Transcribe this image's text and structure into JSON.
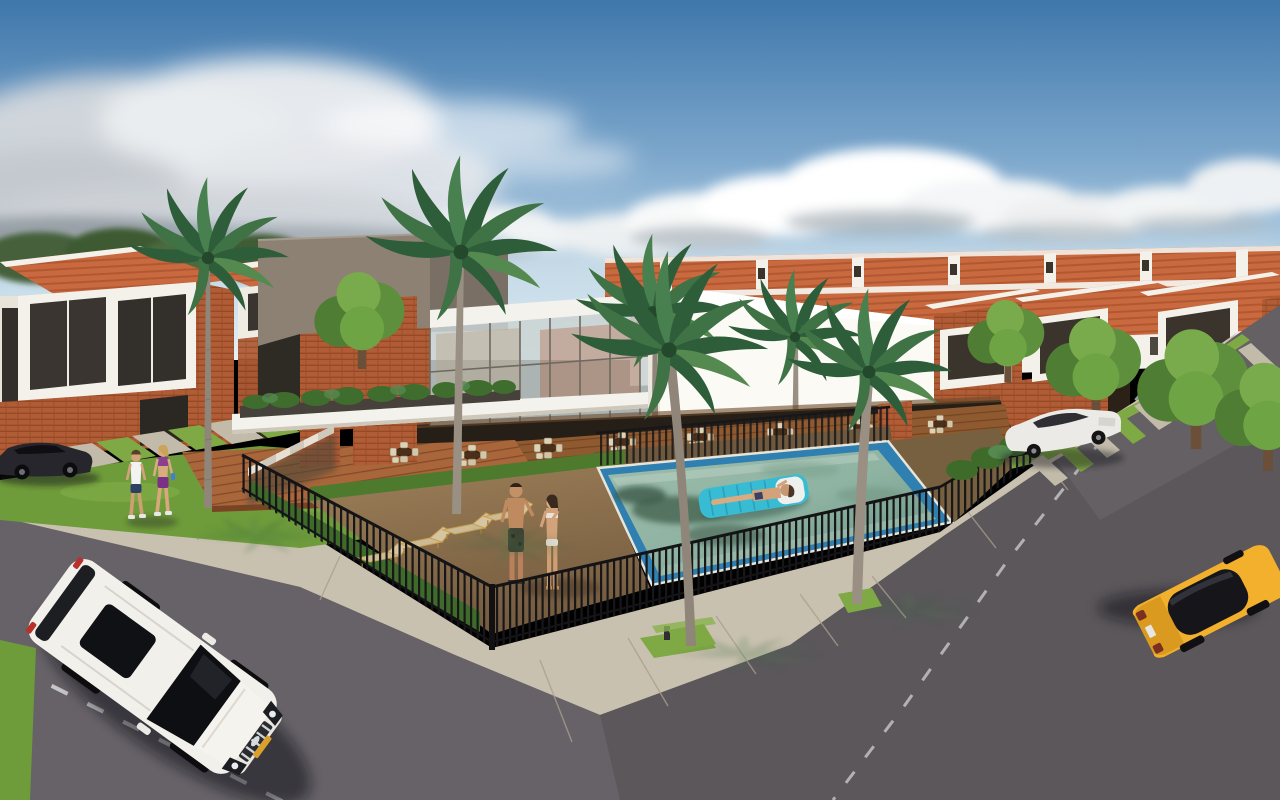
{
  "scene": {
    "type": "3d-architectural-rendering",
    "subject": "Gated townhouse community with central clubhouse, terrace restaurant, swimming pool and corner streets",
    "setting": "daytime, partly cloudy sky, tropical palms",
    "elements": [
      "sky-with-clouds",
      "townhouse-rows-with-tile-roofs",
      "clubhouse-with-glass-facade",
      "terrace-restaurant",
      "swimming-pool",
      "sunbather-on-float",
      "sand-lounge-area-with-loungers",
      "poolside-couple",
      "wrought-iron-fence",
      "palm-trees",
      "front-street",
      "side-street",
      "concrete-sidewalks",
      "white-suv",
      "yellow-sports-car",
      "white-sedan",
      "dark-parked-car",
      "two-women-walking"
    ]
  },
  "colors": {
    "sky_top": "#3f77ab",
    "sky_mid": "#7fa9cd",
    "sky_low": "#c6dcea",
    "sky_horizon": "#e9f0f2",
    "cloud_white": "#ffffff",
    "cloud_gray": "#aeb6bd",
    "roof_orange": "#c8693f",
    "roof_line": "#a34c28",
    "wall_white": "#f4f1ea",
    "gable_white": "#fbfaf5",
    "brick": "#b05c36",
    "glass_dark": "#37322b",
    "taupe_front": "#8d8174",
    "taupe_side": "#7a6f64",
    "slab_white": "#f4f2ec",
    "hedge": "#3e6b2a",
    "lawn": "#6f9c3a",
    "grass_strip": "#7fa944",
    "sand": "#83684a",
    "pool_border": "#2f7fb0",
    "pool_water": "#8fb3a2",
    "float_blue": "#38bcd4",
    "fence": "#17171a",
    "sidewalk": "#c9c1af",
    "road": "#5b575b",
    "road_line": "#d9d9d9",
    "suv_white": "#f2f0eb",
    "dark_car": "#26262c",
    "sedan_white": "#eceae6",
    "sports_yellow": "#f2b02c",
    "plate_yellow": "#dba02b",
    "skin": "#d2a27b",
    "lounger_wood": "#c9a14f",
    "lounger_cushion": "#cdbb97",
    "chair_cream": "#dcd2b6",
    "table_brown": "#4a2f1a",
    "deck_wood": "#a8663a",
    "palm_green": "#2e5d3a",
    "trunk_gray": "#8f8578",
    "tree_green": "#5d8f3c"
  }
}
